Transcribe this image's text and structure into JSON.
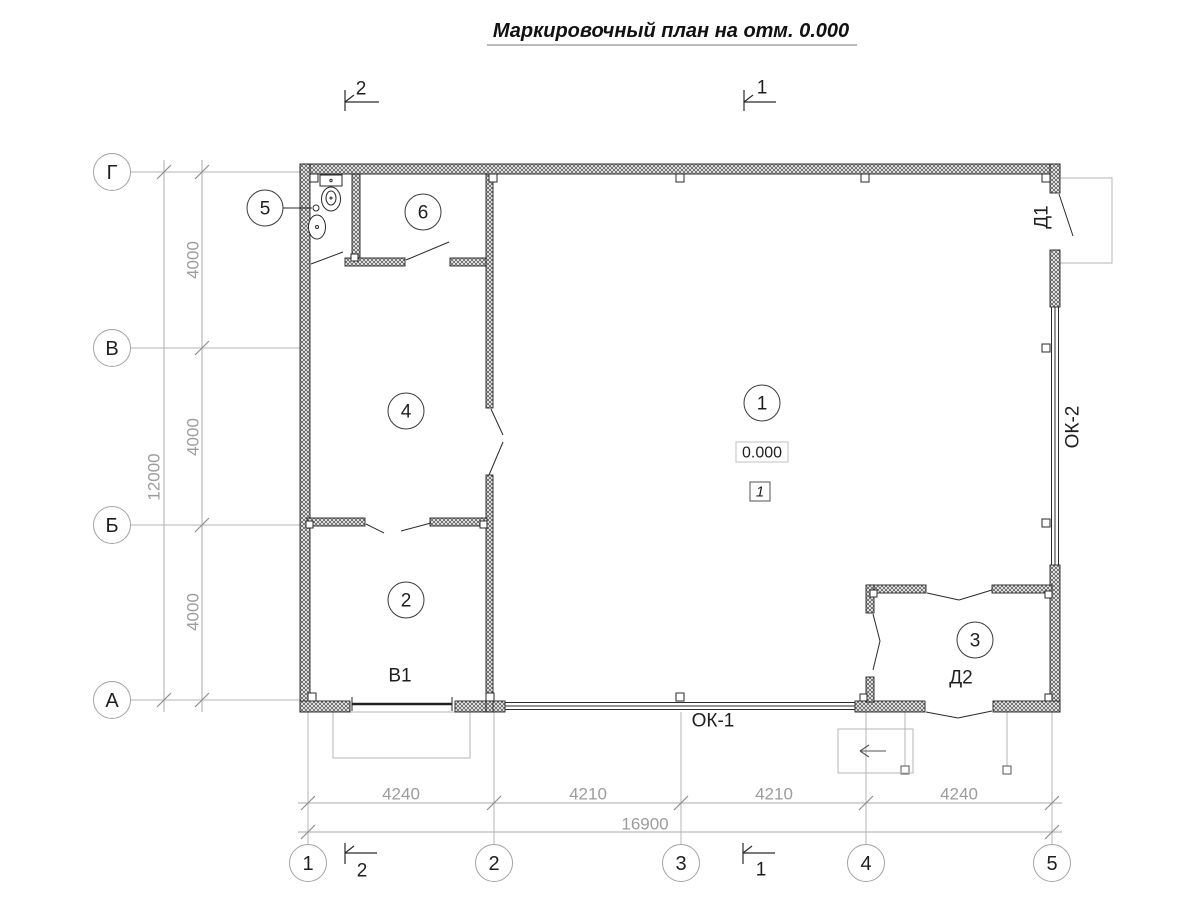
{
  "title": {
    "text": "Маркировочный план на отм. 0.000"
  },
  "axes": {
    "rows": [
      {
        "label": "Г"
      },
      {
        "label": "В"
      },
      {
        "label": "Б"
      },
      {
        "label": "А"
      }
    ],
    "cols": [
      {
        "label": "1"
      },
      {
        "label": "2"
      },
      {
        "label": "3"
      },
      {
        "label": "4"
      },
      {
        "label": "5"
      }
    ]
  },
  "dimensions": {
    "left": {
      "segments": [
        "4000",
        "4000",
        "4000"
      ],
      "total": "12000"
    },
    "bottom": {
      "segments": [
        "4240",
        "4210",
        "4210",
        "4240"
      ],
      "total": "16900"
    }
  },
  "sections": {
    "one": "1",
    "two": "2"
  },
  "rooms": [
    {
      "number": "1"
    },
    {
      "number": "2"
    },
    {
      "number": "3"
    },
    {
      "number": "4"
    },
    {
      "number": "5"
    },
    {
      "number": "6"
    }
  ],
  "marks": {
    "elevation": "0.000",
    "floor_type": "1",
    "door_d1": "Д1",
    "door_d2": "Д2",
    "gate_v1": "В1",
    "window_ok1": "ОК-1",
    "window_ok2": "ОК-2"
  },
  "colors": {
    "line": "#2a2a2a",
    "dim_gray": "#9c9c9c",
    "light_gray": "#b6b6b6",
    "background": "#ffffff"
  }
}
